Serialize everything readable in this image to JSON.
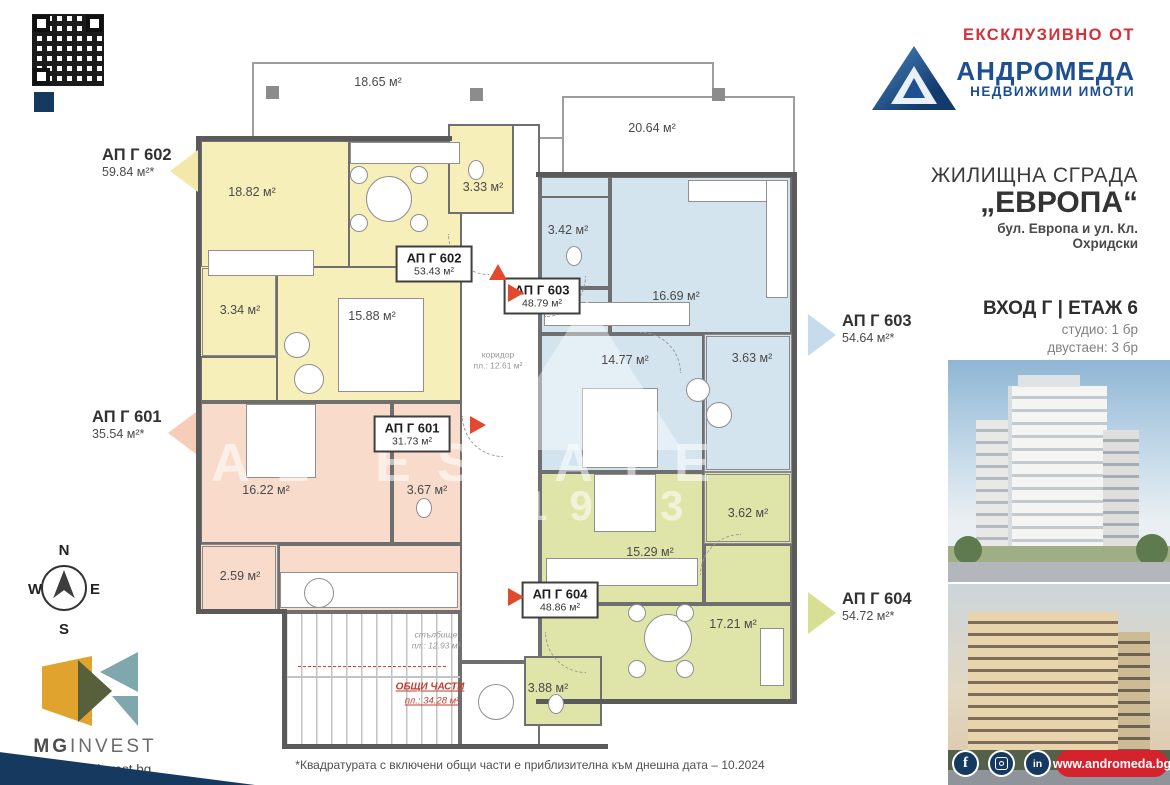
{
  "branding": {
    "exclusive": "ЕКСКЛУЗИВНО ОТ",
    "agency": "АНДРОМЕДА",
    "agency_sub": "НЕДВИЖИМИ ИМОТИ",
    "agency_site": "www.andromeda.bg",
    "developer_mg": "MG",
    "developer_invest": "INVEST",
    "developer_site": "www.mnginvest.bg",
    "facebook_glyph": "f",
    "linkedin_glyph": "in"
  },
  "project": {
    "type": "ЖИЛИЩНА СГРАДА",
    "name": "„ЕВРОПА“",
    "address": "бул. Европа и ул. Кл. Охридски",
    "entrance": "ВХОД Г | ЕТАЖ 6",
    "unit_mix_1": "студио: 1 бр",
    "unit_mix_2": "двустаен: 3 бр"
  },
  "apartments": {
    "g602": {
      "id": "АП Г 602",
      "total": "59.84 м²*",
      "plan": "53.43 м²"
    },
    "g601": {
      "id": "АП Г 601",
      "total": "35.54 м²*",
      "plan": "31.73 м²"
    },
    "g603": {
      "id": "АП Г 603",
      "total": "54.64 м²*",
      "plan": "48.79 м²"
    },
    "g604": {
      "id": "АП Г 604",
      "total": "54.72 м²*",
      "plan": "48.86 м²"
    }
  },
  "areas": {
    "terrace_left": "18.65 м²",
    "terrace_right": "20.64 м²",
    "a602_living": "18.82 м²",
    "a602_bath": "3.33 м²",
    "a602_balcony": "3.34 м²",
    "a602_bedroom": "15.88 м²",
    "a603_bath": "3.42 м²",
    "a603_living": "16.69 м²",
    "a603_bedroom": "14.77 м²",
    "a603_balcony": "3.63 м²",
    "a601_living": "16.22 м²",
    "a601_bath": "3.67 м²",
    "a601_balcony": "2.59 м²",
    "a604_bedroom": "15.29 м²",
    "a604_balcony": "3.62 м²",
    "a604_living": "17.21 м²",
    "a604_bath": "3.88 м²"
  },
  "common": {
    "title": "ОБЩИ ЧАСТИ",
    "area": "пл.: 34.28 м²",
    "stairs_label": "стълбище",
    "stairs_area": "пл.: 12.93 м²",
    "corridor_label": "коридор",
    "corridor_area": "пл.: 12.61 м²"
  },
  "compass": {
    "n": "N",
    "e": "E",
    "s": "S",
    "w": "W"
  },
  "watermark": {
    "text": "REAL ESTATE",
    "year": "1993"
  },
  "footnote": "*Квадратурата с включени общи части е приблизителна към днешна дата – 10.2024"
}
